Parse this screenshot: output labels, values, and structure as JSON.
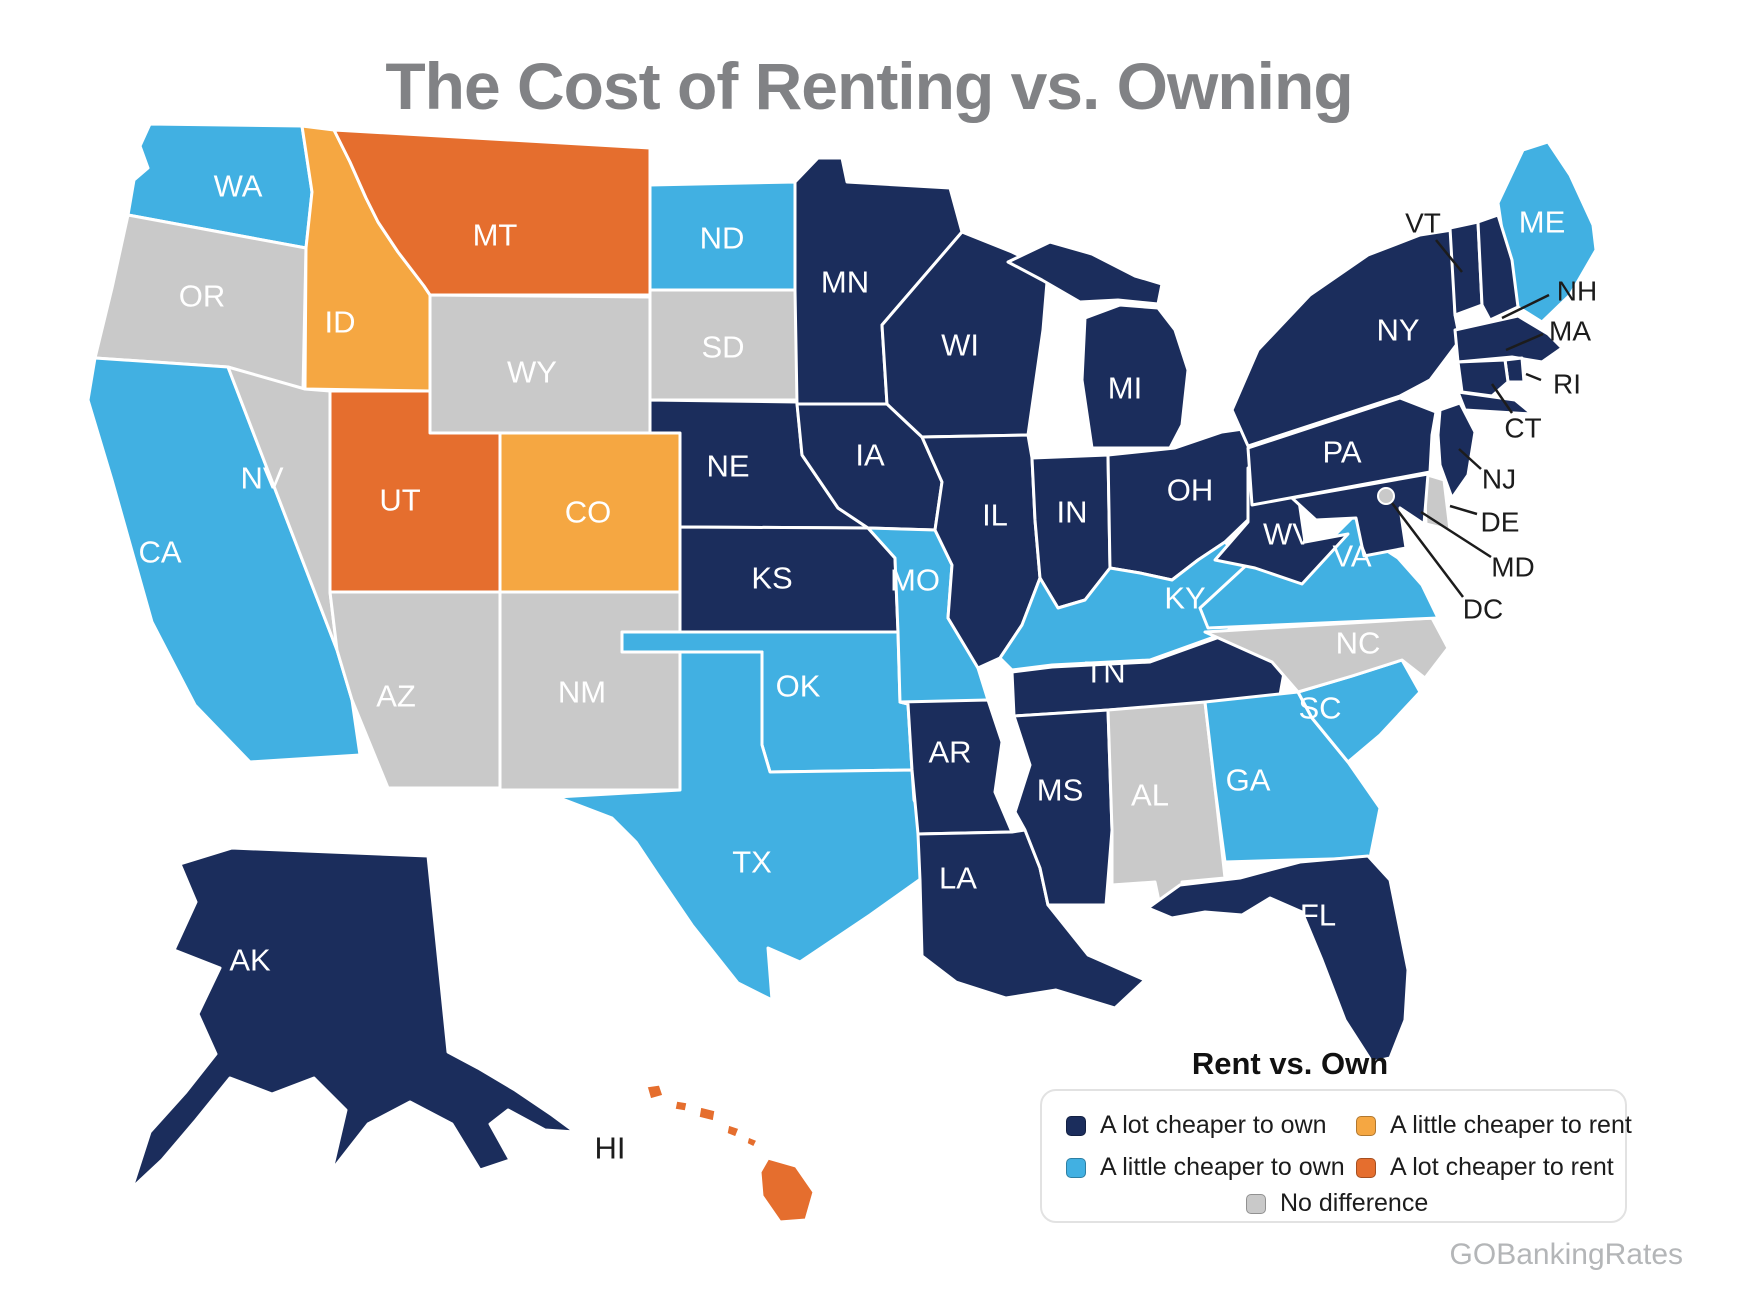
{
  "title": "The Cost of Renting vs. Owning",
  "watermark": "GOBankingRates",
  "colors": {
    "a_lot_own": "#1b2d5c",
    "a_little_own": "#41b0e2",
    "a_little_rent": "#f5a742",
    "a_lot_rent": "#e56e2e",
    "no_difference": "#c9c9c9"
  },
  "legend": {
    "title": "Rent vs. Own",
    "items": [
      {
        "label": "A lot cheaper to own",
        "category": "a_lot_own"
      },
      {
        "label": "A little cheaper to rent",
        "category": "a_little_rent"
      },
      {
        "label": "A little cheaper to own",
        "category": "a_little_own"
      },
      {
        "label": "A lot cheaper to rent",
        "category": "a_lot_rent"
      },
      {
        "label": "No difference",
        "category": "no_difference"
      }
    ]
  },
  "states": [
    {
      "abbr": "WA",
      "label": "WA",
      "category": "a_little_own"
    },
    {
      "abbr": "OR",
      "label": "OR",
      "category": "no_difference"
    },
    {
      "abbr": "CA",
      "label": "CA",
      "category": "a_little_own"
    },
    {
      "abbr": "NV",
      "label": "NV",
      "category": "no_difference"
    },
    {
      "abbr": "ID",
      "label": "ID",
      "category": "a_little_rent"
    },
    {
      "abbr": "MT",
      "label": "MT",
      "category": "a_lot_rent"
    },
    {
      "abbr": "WY",
      "label": "WY",
      "category": "no_difference"
    },
    {
      "abbr": "UT",
      "label": "UT",
      "category": "a_lot_rent"
    },
    {
      "abbr": "CO",
      "label": "CO",
      "category": "a_little_rent"
    },
    {
      "abbr": "AZ",
      "label": "AZ",
      "category": "no_difference"
    },
    {
      "abbr": "NM",
      "label": "NM",
      "category": "no_difference"
    },
    {
      "abbr": "ND",
      "label": "ND",
      "category": "a_little_own"
    },
    {
      "abbr": "SD",
      "label": "SD",
      "category": "no_difference"
    },
    {
      "abbr": "NE",
      "label": "NE",
      "category": "a_lot_own"
    },
    {
      "abbr": "KS",
      "label": "KS",
      "category": "a_lot_own"
    },
    {
      "abbr": "OK",
      "label": "OK",
      "category": "a_little_own"
    },
    {
      "abbr": "TX",
      "label": "TX",
      "category": "a_little_own"
    },
    {
      "abbr": "MN",
      "label": "MN",
      "category": "a_lot_own"
    },
    {
      "abbr": "IA",
      "label": "IA",
      "category": "a_lot_own"
    },
    {
      "abbr": "MO",
      "label": "MO",
      "category": "a_little_own"
    },
    {
      "abbr": "AR",
      "label": "AR",
      "category": "a_lot_own"
    },
    {
      "abbr": "LA",
      "label": "LA",
      "category": "a_lot_own"
    },
    {
      "abbr": "WI",
      "label": "WI",
      "category": "a_lot_own"
    },
    {
      "abbr": "IL",
      "label": "IL",
      "category": "a_lot_own"
    },
    {
      "abbr": "MI",
      "label": "MI",
      "category": "a_lot_own"
    },
    {
      "abbr": "IN",
      "label": "IN",
      "category": "a_lot_own"
    },
    {
      "abbr": "OH",
      "label": "OH",
      "category": "a_lot_own"
    },
    {
      "abbr": "KY",
      "label": "KY",
      "category": "a_little_own"
    },
    {
      "abbr": "TN",
      "label": "TN",
      "category": "a_lot_own"
    },
    {
      "abbr": "MS",
      "label": "MS",
      "category": "a_lot_own"
    },
    {
      "abbr": "AL",
      "label": "AL",
      "category": "no_difference"
    },
    {
      "abbr": "GA",
      "label": "GA",
      "category": "a_little_own"
    },
    {
      "abbr": "SC",
      "label": "SC",
      "category": "a_little_own"
    },
    {
      "abbr": "NC",
      "label": "NC",
      "category": "no_difference"
    },
    {
      "abbr": "FL",
      "label": "FL",
      "category": "a_lot_own"
    },
    {
      "abbr": "VA",
      "label": "VA",
      "category": "a_little_own"
    },
    {
      "abbr": "WV",
      "label": "WV",
      "category": "a_lot_own"
    },
    {
      "abbr": "PA",
      "label": "PA",
      "category": "a_lot_own"
    },
    {
      "abbr": "NY",
      "label": "NY",
      "category": "a_lot_own"
    },
    {
      "abbr": "ME",
      "label": "ME",
      "category": "a_little_own"
    },
    {
      "abbr": "VT",
      "label": "",
      "category": "a_lot_own"
    },
    {
      "abbr": "NH",
      "label": "",
      "category": "a_lot_own"
    },
    {
      "abbr": "MA",
      "label": "",
      "category": "a_lot_own"
    },
    {
      "abbr": "RI",
      "label": "",
      "category": "a_lot_own"
    },
    {
      "abbr": "CT",
      "label": "",
      "category": "a_lot_own"
    },
    {
      "abbr": "NJ",
      "label": "",
      "category": "a_lot_own"
    },
    {
      "abbr": "DE",
      "label": "",
      "category": "no_difference"
    },
    {
      "abbr": "MD",
      "label": "",
      "category": "a_lot_own"
    },
    {
      "abbr": "DC",
      "label": "",
      "category": "no_difference"
    },
    {
      "abbr": "AK",
      "label": "AK",
      "category": "a_lot_own"
    },
    {
      "abbr": "HI",
      "label": "HI",
      "category": "a_lot_rent",
      "label_color": "#1c1c1c"
    }
  ],
  "callouts": [
    {
      "label": "VT"
    },
    {
      "label": "NH"
    },
    {
      "label": "MA"
    },
    {
      "label": "RI"
    },
    {
      "label": "CT"
    },
    {
      "label": "NJ"
    },
    {
      "label": "DE"
    },
    {
      "label": "MD"
    },
    {
      "label": "DC"
    }
  ]
}
